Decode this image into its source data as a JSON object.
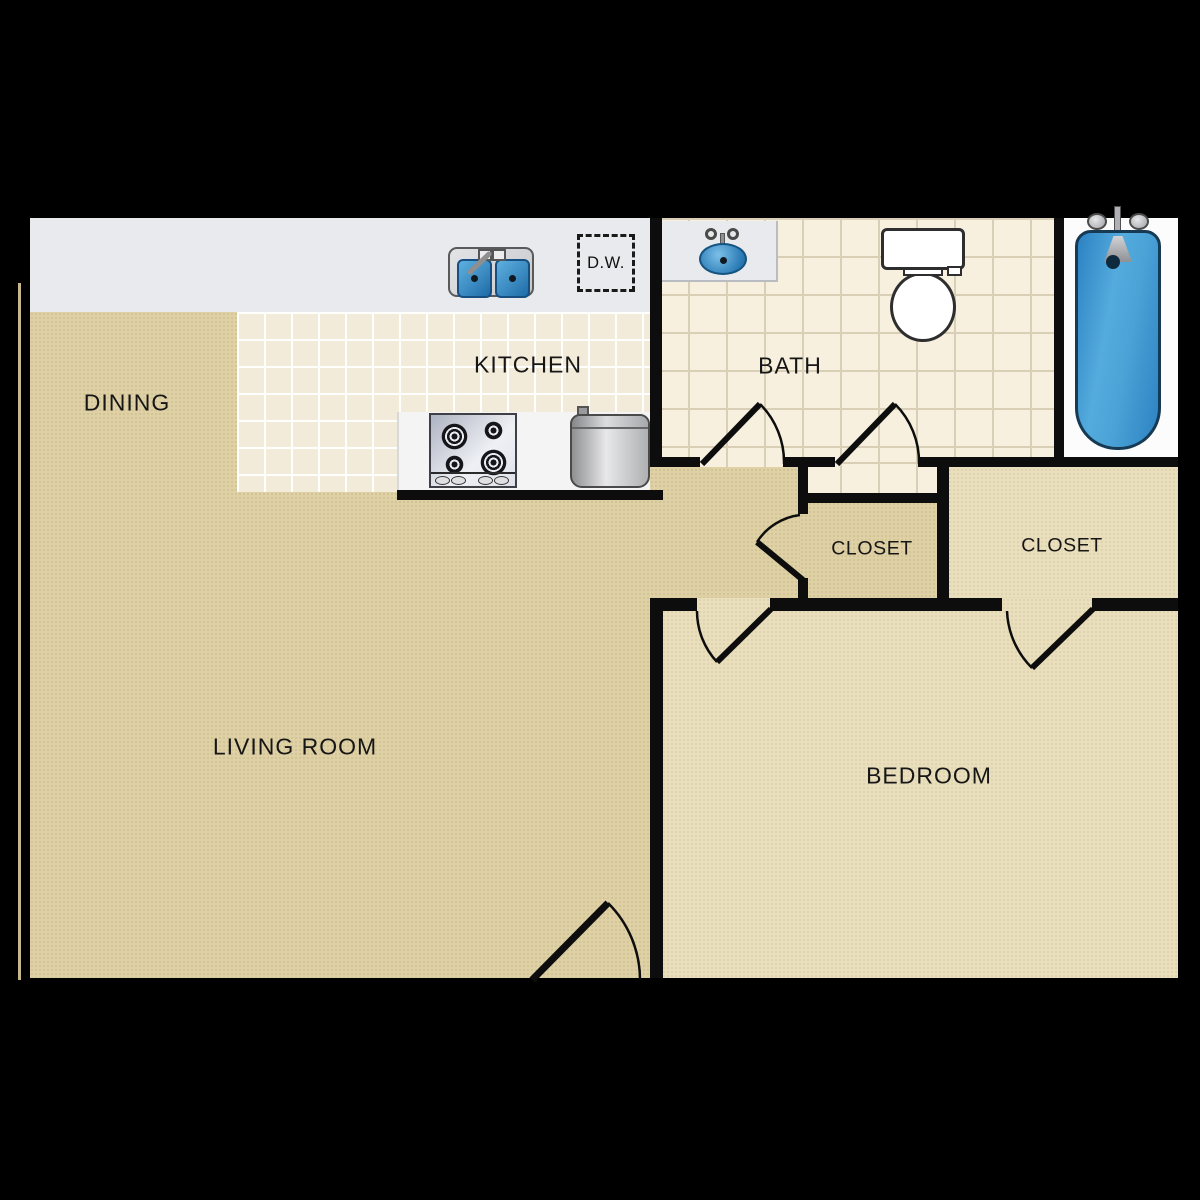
{
  "title": "One-bedroom apartment floor plan",
  "rooms": {
    "dining": {
      "label": "DINING"
    },
    "kitchen": {
      "label": "KITCHEN"
    },
    "bath": {
      "label": "BATH"
    },
    "closet_hall": {
      "label": "CLOSET"
    },
    "closet_bedroom": {
      "label": "CLOSET"
    },
    "living_room": {
      "label": "LIVING ROOM"
    },
    "bedroom": {
      "label": "BEDROOM"
    }
  },
  "fixtures": {
    "dishwasher": {
      "label": "D.W."
    },
    "kitchen_sink": "double-basin-sink",
    "stove": "four-burner-cooktop",
    "water_heater": "water-heater",
    "bath_sink": "oval-vanity-sink",
    "toilet": "toilet",
    "bathtub": "bathtub"
  },
  "colors": {
    "background": "#000000",
    "carpet": "#dfd1a5",
    "carpet_bedroom": "#eadfbc",
    "kitchen_tile": "#f2ebd9",
    "bath_tile": "#f7f0df",
    "counter": "#e9eaed",
    "tub_alcove": "#fcfcfc",
    "wall": "#0d0d0d",
    "fixture_blue": "#3f9bd4"
  }
}
